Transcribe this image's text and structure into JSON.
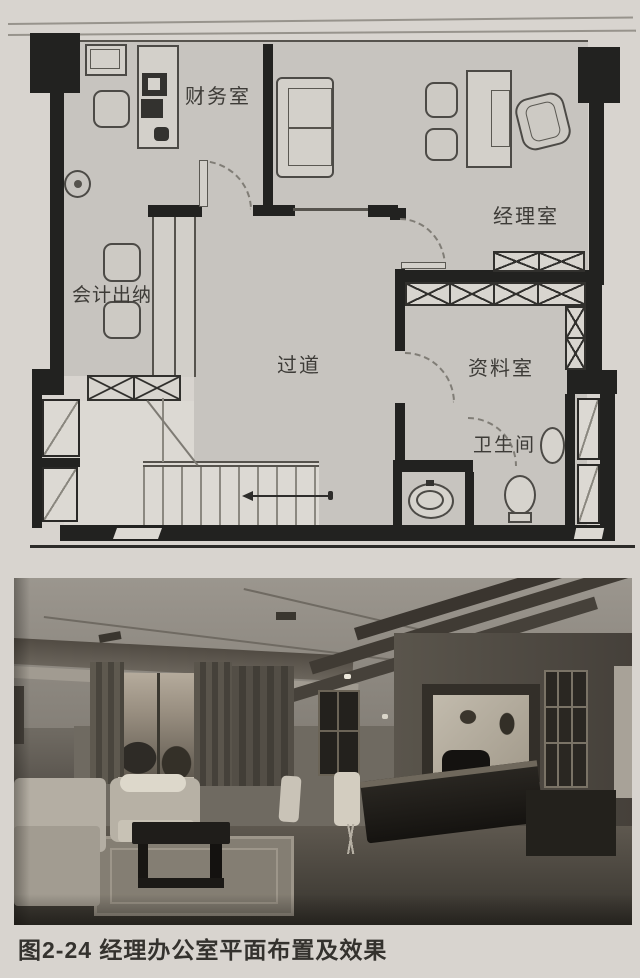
{
  "figure": {
    "caption": "图2-24 经理办公室平面布置及效果"
  },
  "floor_plan": {
    "labels": {
      "finance": "财务室",
      "manager": "经理室",
      "accounting": "会计出纳",
      "corridor": "过道",
      "archive": "资料室",
      "bathroom": "卫生间"
    },
    "colors": {
      "wall": "#222220",
      "room_fill": "#c7c4bf",
      "paper": "#d8d4cf",
      "hatch_line": "#31302d"
    }
  }
}
